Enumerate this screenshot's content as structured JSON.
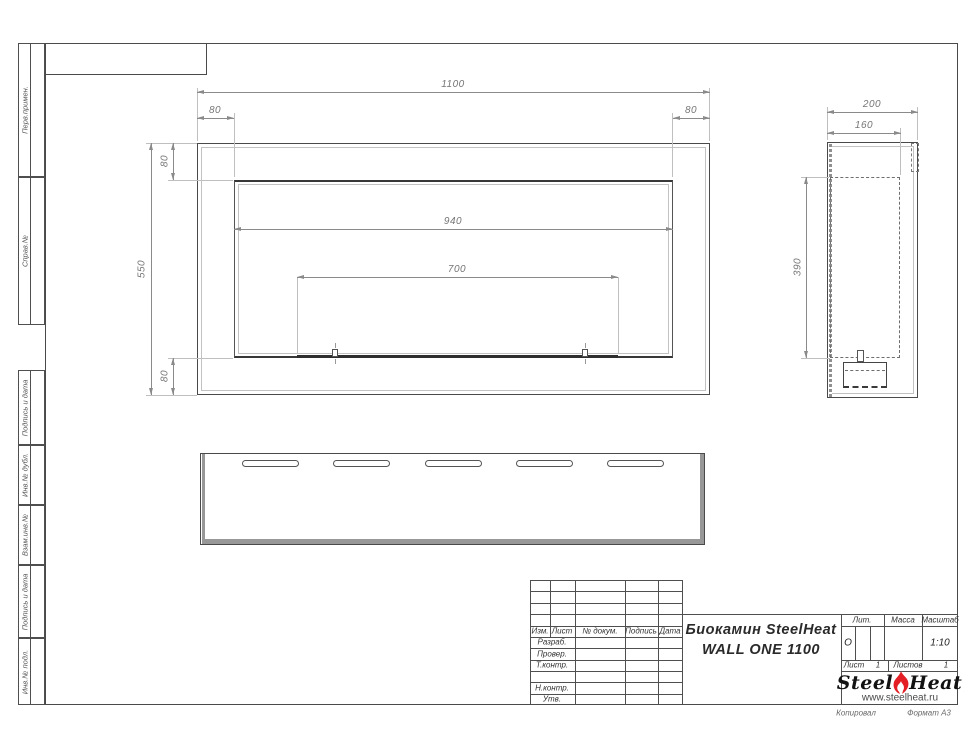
{
  "sidebar": {
    "labels": [
      "Перв.примен.",
      "Справ.№",
      "Подпись и дата",
      "Инв.№ дубл.",
      "Взам.инв.№",
      "Подпись и дата",
      "Инв.№ подл."
    ]
  },
  "front_view": {
    "dims": {
      "total_width": "1100",
      "total_height": "550",
      "flange_left": "80",
      "flange_right": "80",
      "flange_top": "80",
      "flange_bottom": "80",
      "opening_width": "940",
      "burner_width": "700"
    }
  },
  "side_view": {
    "dims": {
      "depth": "200",
      "inner_depth": "160",
      "inner_height": "390"
    }
  },
  "title_block": {
    "revision_header": {
      "izm": "Изм.",
      "list": "Лист",
      "doc": "№ докум.",
      "sign": "Подпись",
      "date": "Дата"
    },
    "role_rows": [
      "Разраб.",
      "Провер.",
      "Т.контр.",
      "",
      "Н.контр.",
      "Утв."
    ],
    "title_line1": "Биокамин SteelHeat",
    "title_line2": "WALL ONE 1100",
    "lit": {
      "label": "Лит.",
      "value": "О"
    },
    "mass": {
      "label": "Масса",
      "value": ""
    },
    "scale": {
      "label": "Масштаб",
      "value": "1:10"
    },
    "sheet": {
      "label": "Лист",
      "value": "1"
    },
    "sheets": {
      "label": "Листов",
      "value": "1"
    },
    "logo": {
      "steel": "Steel",
      "heat": "Heat",
      "site": "www.steelheat.ru"
    }
  },
  "footer": {
    "copied": "Копировал",
    "format": "Формат А3"
  },
  "colors": {
    "line": "#4f4f4f",
    "dim_line": "#8a8a8a",
    "dim_text": "#767676",
    "flame": "#e31e24"
  }
}
